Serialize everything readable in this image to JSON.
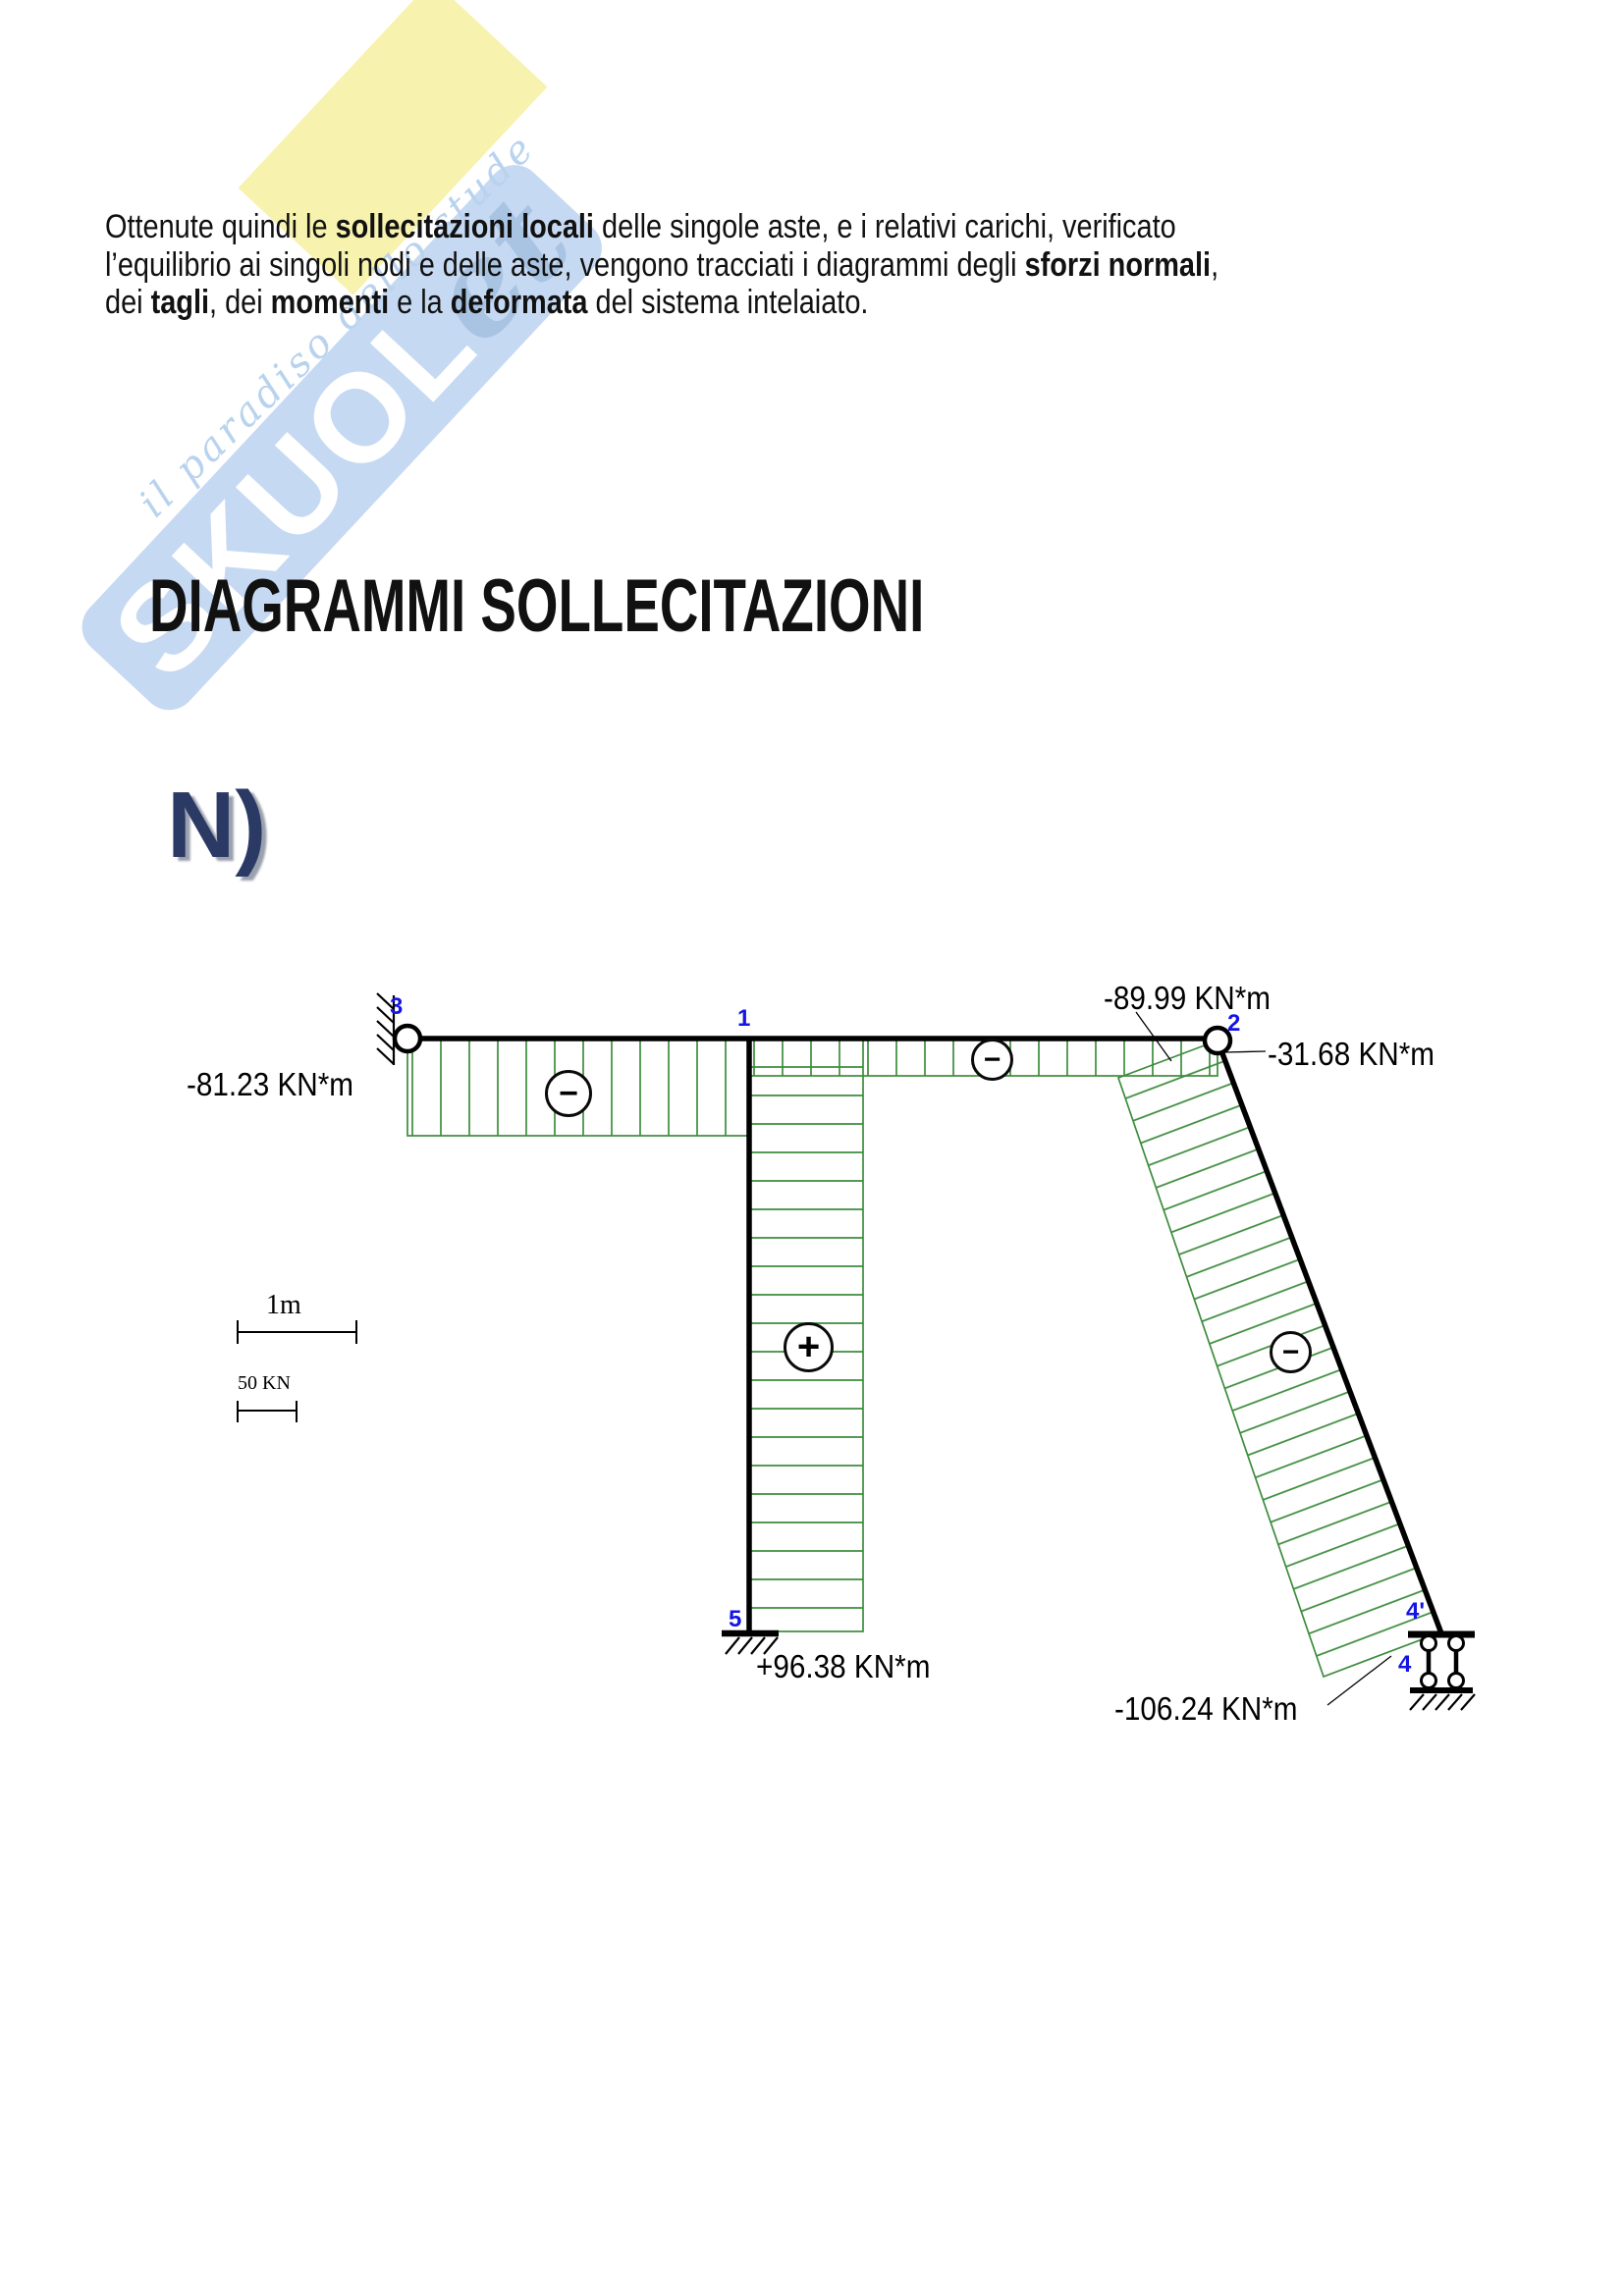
{
  "watermark": {
    "brand_main": "SKUOL",
    "brand_script": "et",
    "tagline": "il paradiso dello stude"
  },
  "intro_paragraph": {
    "lines": [
      [
        {
          "text": "Ottenute quindi le ",
          "bold": false
        },
        {
          "text": "sollecitazioni locali",
          "bold": true
        },
        {
          "text": " delle singole aste, e  i relativi carichi, verificato",
          "bold": false
        }
      ],
      [
        {
          "text": "l’equilibrio ai singoli nodi e delle aste, vengono tracciati i diagrammi degli ",
          "bold": false
        },
        {
          "text": "sforzi normali",
          "bold": true
        },
        {
          "text": ",",
          "bold": false
        }
      ],
      [
        {
          "text": "dei ",
          "bold": false
        },
        {
          "text": "tagli",
          "bold": true
        },
        {
          "text": ", dei ",
          "bold": false
        },
        {
          "text": "momenti",
          "bold": true
        },
        {
          "text": " e la ",
          "bold": false
        },
        {
          "text": "deformata",
          "bold": true
        },
        {
          "text": " del sistema intelaiato.",
          "bold": false
        }
      ]
    ]
  },
  "section_title": "DIAGRAMMI SOLLECITAZIONI",
  "diagram_title": "N)",
  "diagram": {
    "type": "normal-force-diagram",
    "values": {
      "beam_left": "-81.23 KN*m",
      "incline_top": "-89.99 KN*m",
      "beam_right": "-31.68 KN*m",
      "column_base": "+96.38 KN*m",
      "incline_bottom": "-106.24 KN*m"
    },
    "signs": {
      "beam_left": "−",
      "beam_right": "−",
      "column": "+",
      "incline": "−"
    },
    "nodes": {
      "n3": "3",
      "n1": "1",
      "n2": "2",
      "n5": "5",
      "n4_prime": "4'",
      "n4": "4"
    },
    "scale": {
      "length": "1m",
      "force": "50 KN"
    },
    "colors": {
      "diagram_green": "#3d8c3d",
      "node_label_blue": "#1414e6",
      "member_black": "#000000"
    }
  }
}
